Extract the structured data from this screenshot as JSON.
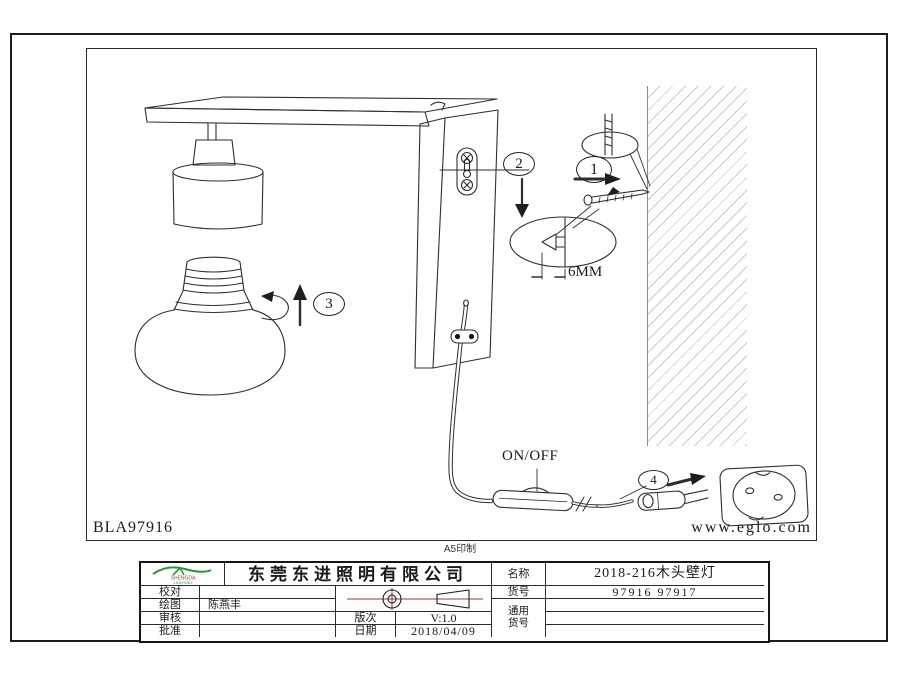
{
  "page": {
    "drawing_code": "BLA97916",
    "website": "www.eglo.com",
    "print_note": "A5印制"
  },
  "diagram": {
    "on_off_label": "ON/OFF",
    "depth_label": "6MM",
    "steps": [
      "1",
      "2",
      "3",
      "4"
    ]
  },
  "title_block": {
    "logo": {
      "line1": "SHENGDA",
      "line2": "LIGHTING",
      "swoosh_color": "#1f9d2f",
      "line1_color": "#c03a2b"
    },
    "company_name": "东莞东进照明有限公司",
    "accent_red": "#a03535",
    "fields": {
      "proofread_label": "校对",
      "proofread_value": "",
      "drawn_label": "绘图",
      "drawn_value": "陈燕丰",
      "review_label": "审核",
      "review_value": "",
      "approve_label": "批准",
      "approve_value": "",
      "version_label": "版次",
      "version_value": "V:1.0",
      "date_label": "日期",
      "date_value": "2018/04/09",
      "product_name_label": "名称",
      "product_name_value": "2018-216木头壁灯",
      "item_no_label": "货号",
      "item_no_value": "97916  97917",
      "generic_label_line1": "通用",
      "generic_label_line2": "货号"
    }
  }
}
